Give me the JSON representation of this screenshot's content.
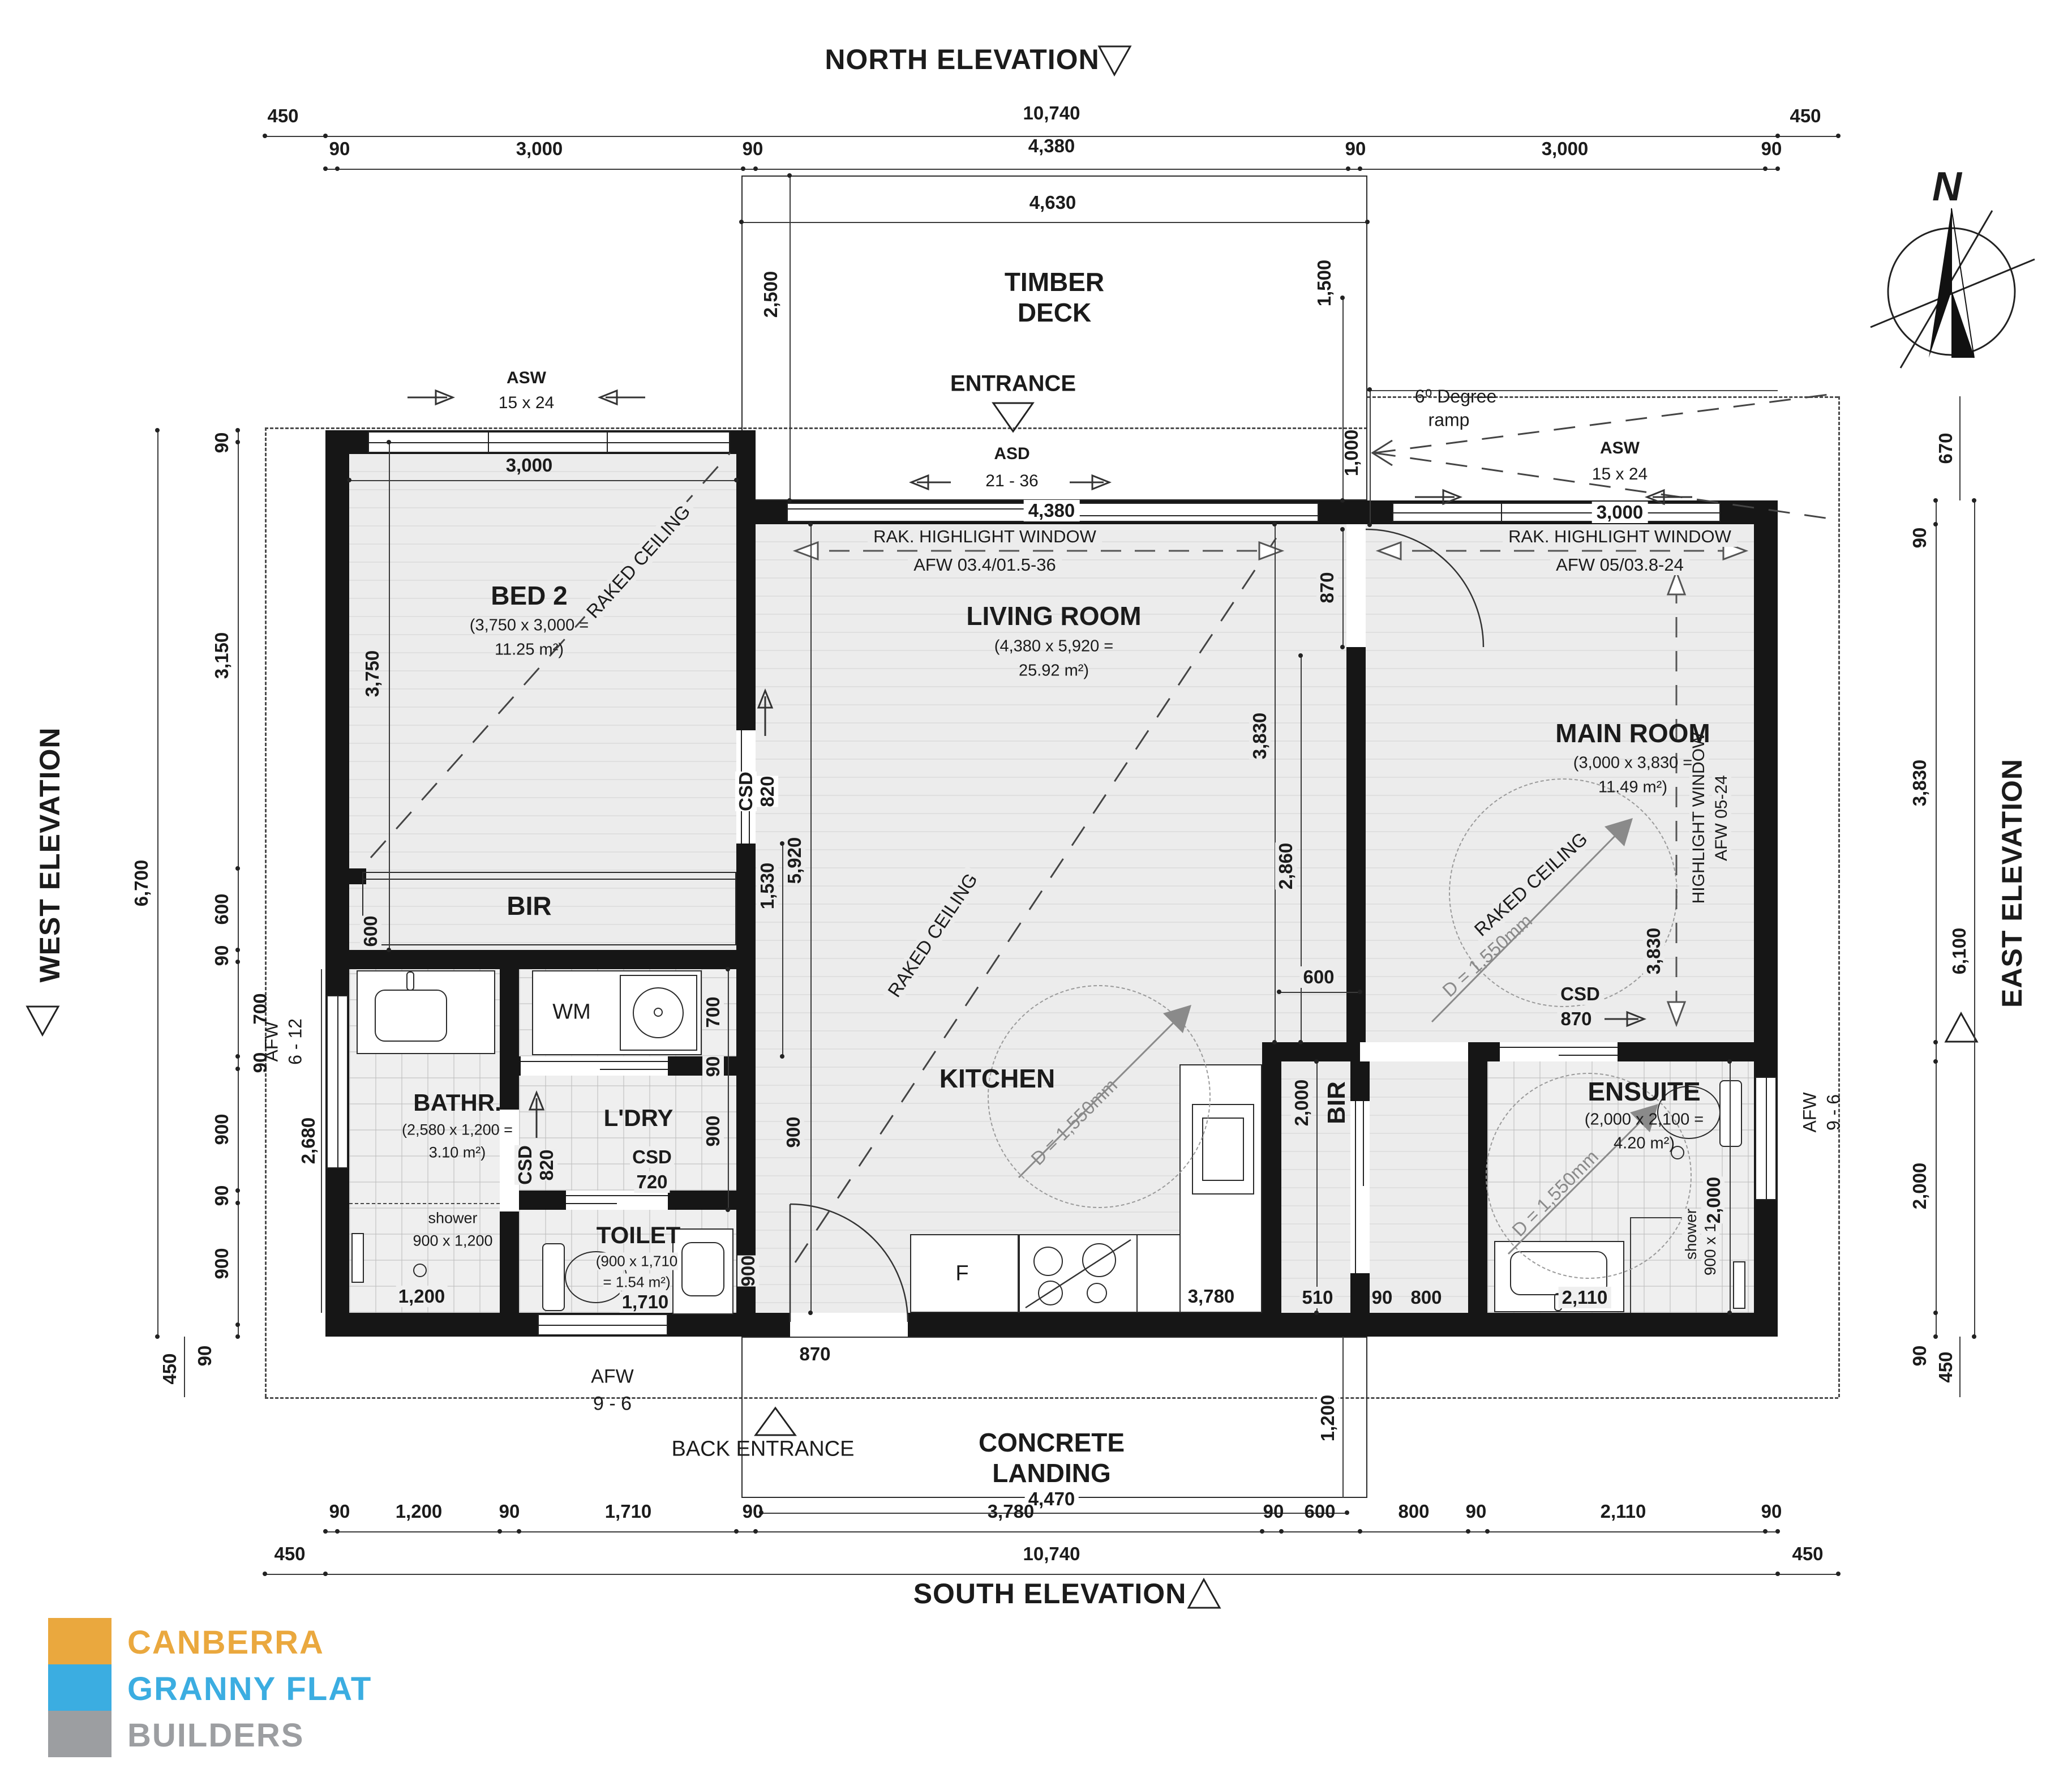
{
  "meta": {
    "north": "NORTH ELEVATION",
    "south": "SOUTH ELEVATION",
    "west": "WEST ELEVATION",
    "east": "EAST ELEVATION",
    "compass_n": "N"
  },
  "logo": {
    "line1": "CANBERRA",
    "line2": "GRANNY FLAT",
    "line3": "BUILDERS",
    "color1": "#EAA83E",
    "color2": "#3BADE1",
    "color3": "#9C9EA1"
  },
  "glyphs": {
    "up": "↑",
    "right": "→",
    "left": "←"
  },
  "top": {
    "row1": [
      "450",
      "10,740",
      "450"
    ],
    "row2": [
      "90",
      "3,000",
      "90",
      "4,380",
      "90",
      "3,000",
      "90"
    ],
    "deck_w": "4,630"
  },
  "deck": {
    "t1": "TIMBER",
    "t2": "DECK",
    "entrance": "ENTRANCE",
    "d_left": "2,500",
    "d_right": "1,500",
    "d_edge": "1,000"
  },
  "ramp": {
    "t1": "6⁰ Degree",
    "t2": "ramp"
  },
  "win": {
    "asw1a": "ASW",
    "asw1b": "15 x 24",
    "asw1w": "3,000",
    "asda": "ASD",
    "asdb": "21 - 36",
    "asdw": "4,380",
    "asw2a": "ASW",
    "asw2b": "15 x 24",
    "asw2w": "3,000",
    "rak1a": "RAK. HIGHLIGHT WINDOW",
    "rak1b": "AFW 03.4/01.5-36",
    "rak2a": "RAK. HIGHLIGHT WINDOW",
    "rak2b": "AFW 05/03.8-24",
    "hw1": "HIGHLIGHT WINDOW",
    "hw2": "AFW 05-24",
    "hw_d": "3,830"
  },
  "bed2": {
    "name": "BED 2",
    "area1": "(3,750 x 3,000 =",
    "area2": "11.25 m²)",
    "raked": "RAKED CEILING",
    "d1": "3,750",
    "bir": "BIR",
    "d600": "600",
    "csd1": "CSD",
    "csd2": "820"
  },
  "living": {
    "name": "LIVING ROOM",
    "area1": "(4,380 x 5,920 =",
    "area2": "25.92 m²)",
    "raked": "RAKED CEILING",
    "d1": "5,920",
    "d2": "1,530",
    "d3": "3,830",
    "d4": "2,860",
    "d5": "870"
  },
  "main": {
    "name": "MAIN ROOM",
    "area1": "(3,000 x 3,830 =",
    "area2": "11.49 m²)",
    "raked": "RAKED CEILING",
    "diam": "D = 1,550mm",
    "csd1": "CSD",
    "csd2": "870",
    "d600": "600"
  },
  "kitchen": {
    "name": "KITCHEN",
    "diam": "D = 1,550mm",
    "fridge": "F",
    "d1": "3,780",
    "d2": "900",
    "d3": "870"
  },
  "bir2": {
    "name": "BIR",
    "d1": "2,000",
    "d2": "510",
    "d3": "90",
    "d4": "800"
  },
  "bath": {
    "name": "BATHR.",
    "area1": "(2,580 x 1,200 =",
    "area2": "3.10 m²)",
    "shower1": "shower",
    "shower2": "900 x 1,200",
    "d1": "1,200",
    "d2": "2,680",
    "afw1": "AFW",
    "afw2": "6 - 12"
  },
  "ldry": {
    "name": "L'DRY",
    "wm": "WM",
    "csda": "CSD",
    "csdb": "820",
    "csdc": "CSD",
    "csdd": "720",
    "d1": "700",
    "d2": "90",
    "d3": "900"
  },
  "toilet": {
    "name": "TOILET",
    "area1": "(900 x 1,710",
    "area2": "= 1.54 m²)",
    "d1": "1,710",
    "d2": "900"
  },
  "ensuite": {
    "name": "ENSUITE",
    "area1": "(2,000 x 2,100 =",
    "area2": "4.20 m²)",
    "diam": "D = 1,550mm",
    "shower1": "shower",
    "shower2": "900 x 1,000",
    "d1": "2,000",
    "d2": "2,110",
    "afw1": "AFW",
    "afw2": "9 - 6"
  },
  "left": {
    "col": [
      "90",
      "3,150",
      "600",
      "90",
      "700",
      "90",
      "900",
      "90",
      "900"
    ],
    "total": "6,700",
    "bath_h": "2,680",
    "sb": "450",
    "sb90": "90"
  },
  "right": {
    "col": [
      "90",
      "3,830",
      "2,000",
      "90"
    ],
    "total": "6,100",
    "top": "670",
    "sb": "450",
    "afw1": "AFW",
    "afw2": "9 - 6"
  },
  "bottom": {
    "row1": [
      "90",
      "1,200",
      "90",
      "1,710",
      "90",
      "3,780",
      "90",
      "600",
      "800",
      "90",
      "2,110",
      "90"
    ],
    "row2": [
      "450",
      "10,740",
      "450"
    ],
    "landing1": "CONCRETE",
    "landing2": "LANDING",
    "landing_w": "4,470",
    "landing_d": "1,200",
    "back": "BACK ENTRANCE",
    "door": "870",
    "afw1": "AFW",
    "afw2": "9 - 6"
  }
}
